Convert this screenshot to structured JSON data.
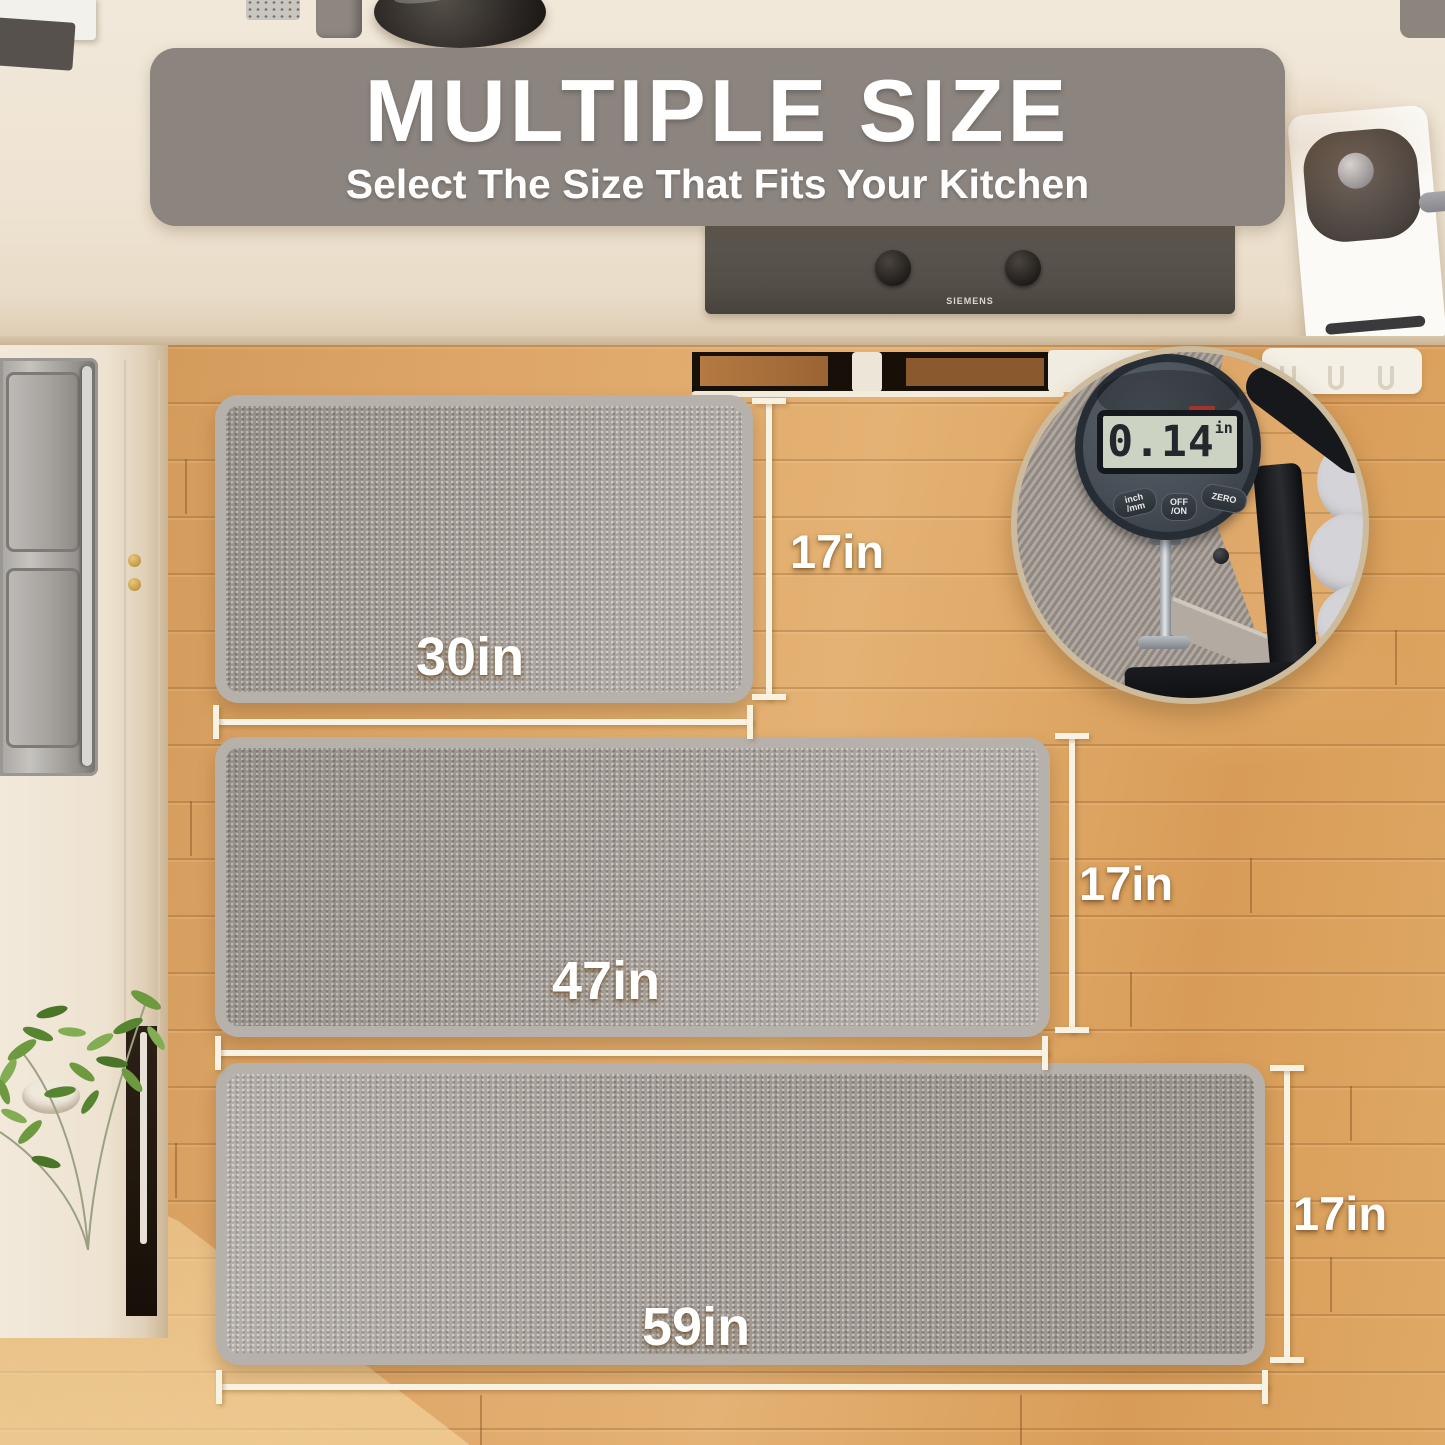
{
  "banner": {
    "title": "MULTIPLE SIZE",
    "subtitle": "Select The Size That Fits Your Kitchen"
  },
  "stove": {
    "brand": "SIEMENS"
  },
  "mats": [
    {
      "name": "small",
      "width_label": "30in",
      "height_label": "17in"
    },
    {
      "name": "medium",
      "width_label": "47in",
      "height_label": "17in"
    },
    {
      "name": "large",
      "width_label": "59in",
      "height_label": "17in"
    }
  ],
  "thickness_gauge": {
    "reading": "0.14",
    "unit": "in",
    "buttons": [
      {
        "line1": "inch",
        "line2": "/mm"
      },
      {
        "line1": "OFF",
        "line2": "/ON"
      },
      {
        "line1": "ZERO",
        "line2": ""
      }
    ]
  },
  "colors": {
    "banner_bg": "#8B847F",
    "text_white": "#FFFFFF",
    "dimension_line": "#F8F2E3",
    "mat_fill": "#A49D97",
    "mat_border": "#B7B1AB",
    "floor_wood": "#D89A58",
    "countertop": "#EFE5D5",
    "stove_body": "#56504B",
    "gauge_body": "#4B525A",
    "gauge_lcd": "#CCD3C2",
    "clamp_black": "#17181B"
  }
}
